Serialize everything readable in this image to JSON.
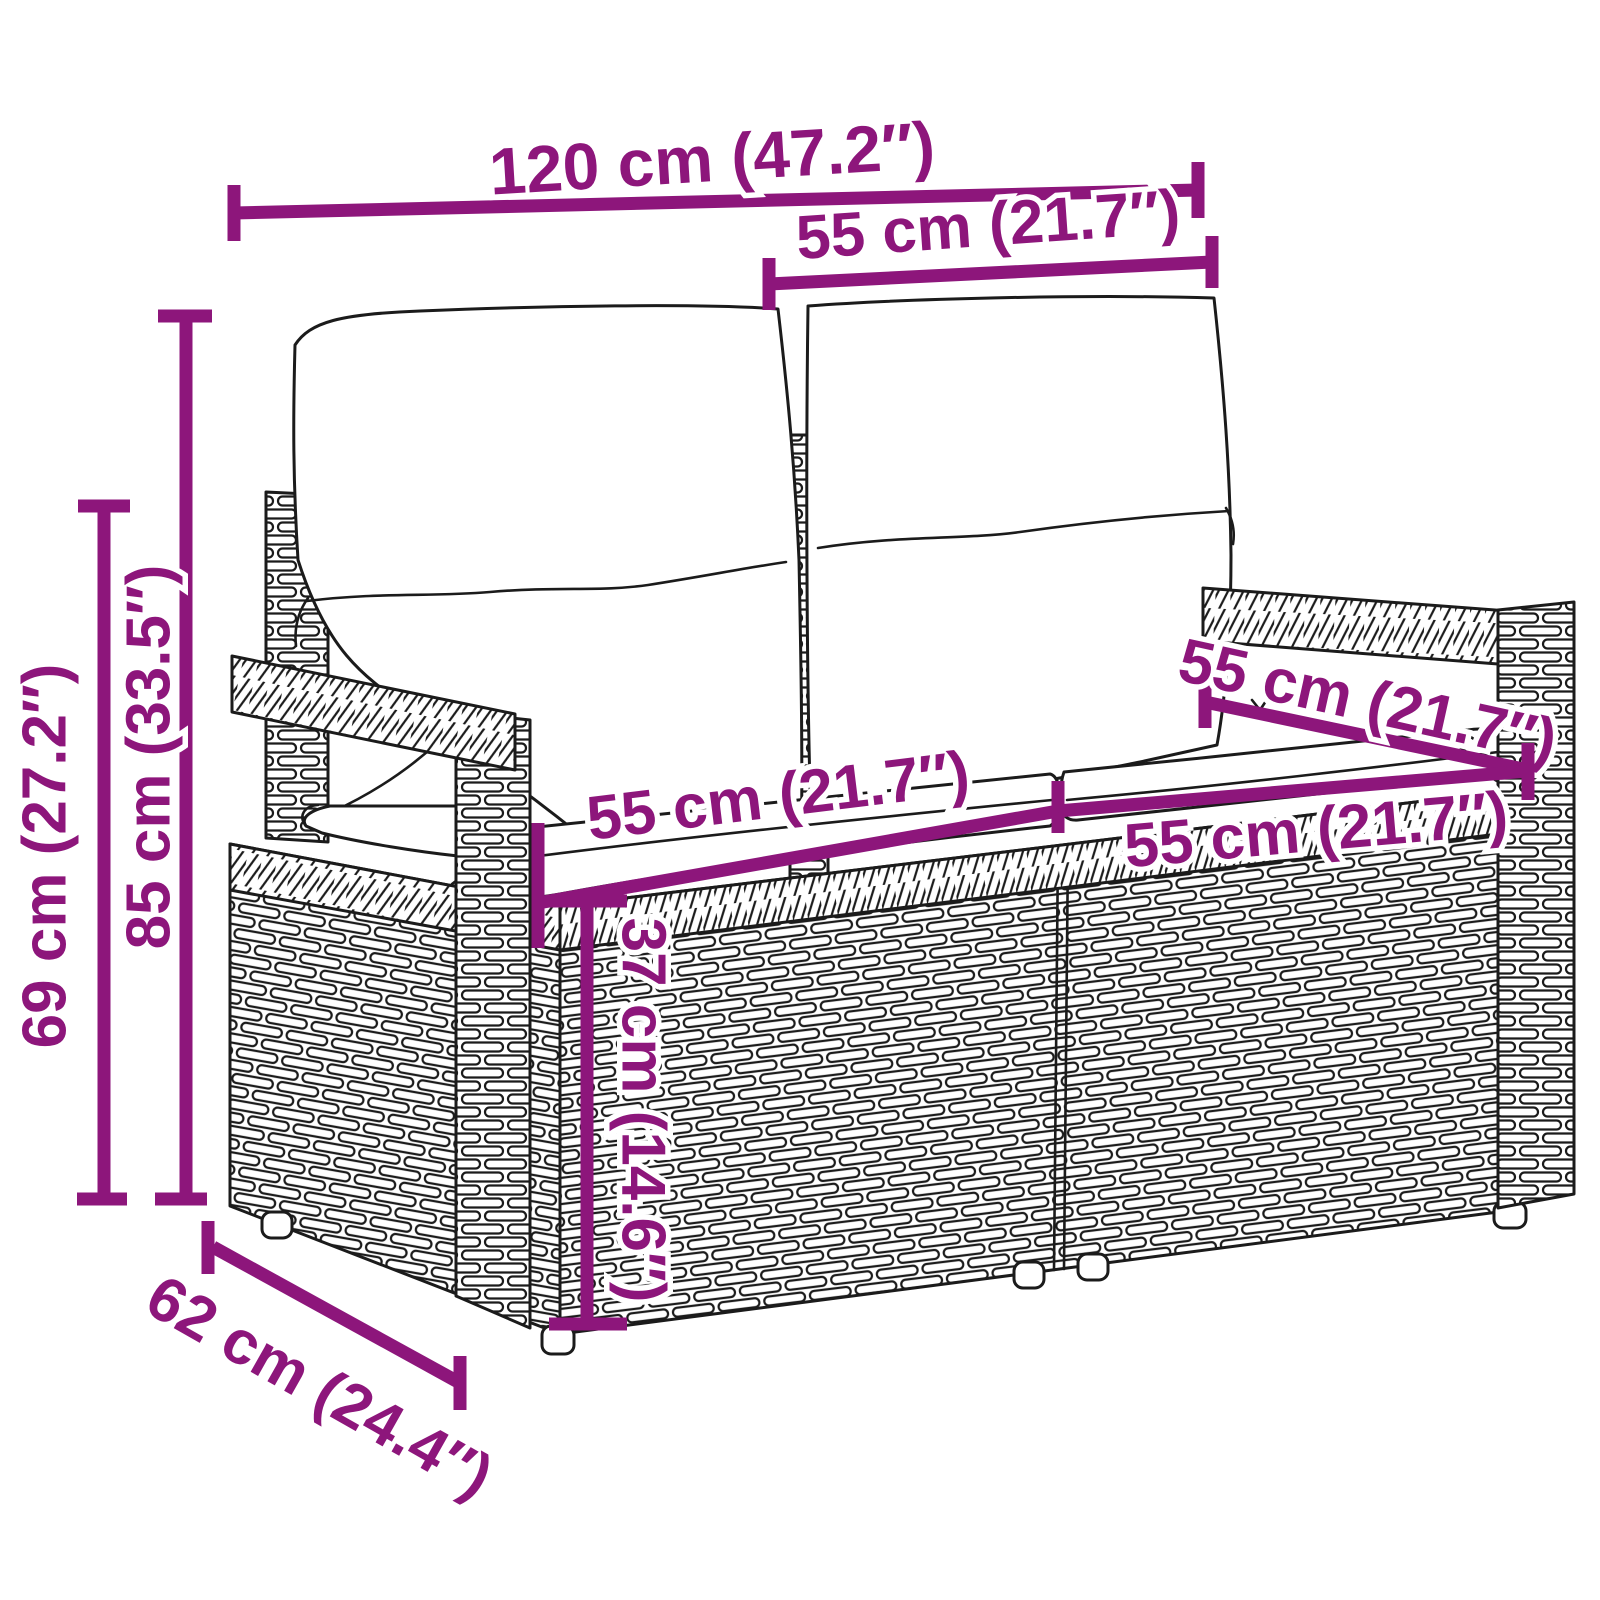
{
  "diagram": {
    "title": "Garden bench dimension diagram",
    "product": "Poly rattan 2-seater garden bench with cushions",
    "accent_color": "#8D167B",
    "line_color": "#1b1b1b",
    "background_color": "#ffffff",
    "dimensions": [
      {
        "id": "overall-width",
        "cm": 120,
        "inches": 47.2,
        "label": "120 cm (47.2″)"
      },
      {
        "id": "back-section-width",
        "cm": 55,
        "inches": 21.7,
        "label": "55 cm (21.7″)"
      },
      {
        "id": "total-height",
        "cm": 85,
        "inches": 33.5,
        "label": "85 cm (33.5″)"
      },
      {
        "id": "armrest-height",
        "cm": 69,
        "inches": 27.2,
        "label": "69 cm (27.2″)"
      },
      {
        "id": "seat-depth",
        "cm": 55,
        "inches": 21.7,
        "label": "55 cm (21.7″)"
      },
      {
        "id": "left-seat-width",
        "cm": 55,
        "inches": 21.7,
        "label": "55 cm (21.7″)"
      },
      {
        "id": "right-seat-width",
        "cm": 55,
        "inches": 21.7,
        "label": "55 cm (21.7″)"
      },
      {
        "id": "seat-height",
        "cm": 37,
        "inches": 14.6,
        "label": "37 cm (14.6″)"
      },
      {
        "id": "base-depth",
        "cm": 62,
        "inches": 24.4,
        "label": "62 cm (24.4″)"
      }
    ]
  }
}
